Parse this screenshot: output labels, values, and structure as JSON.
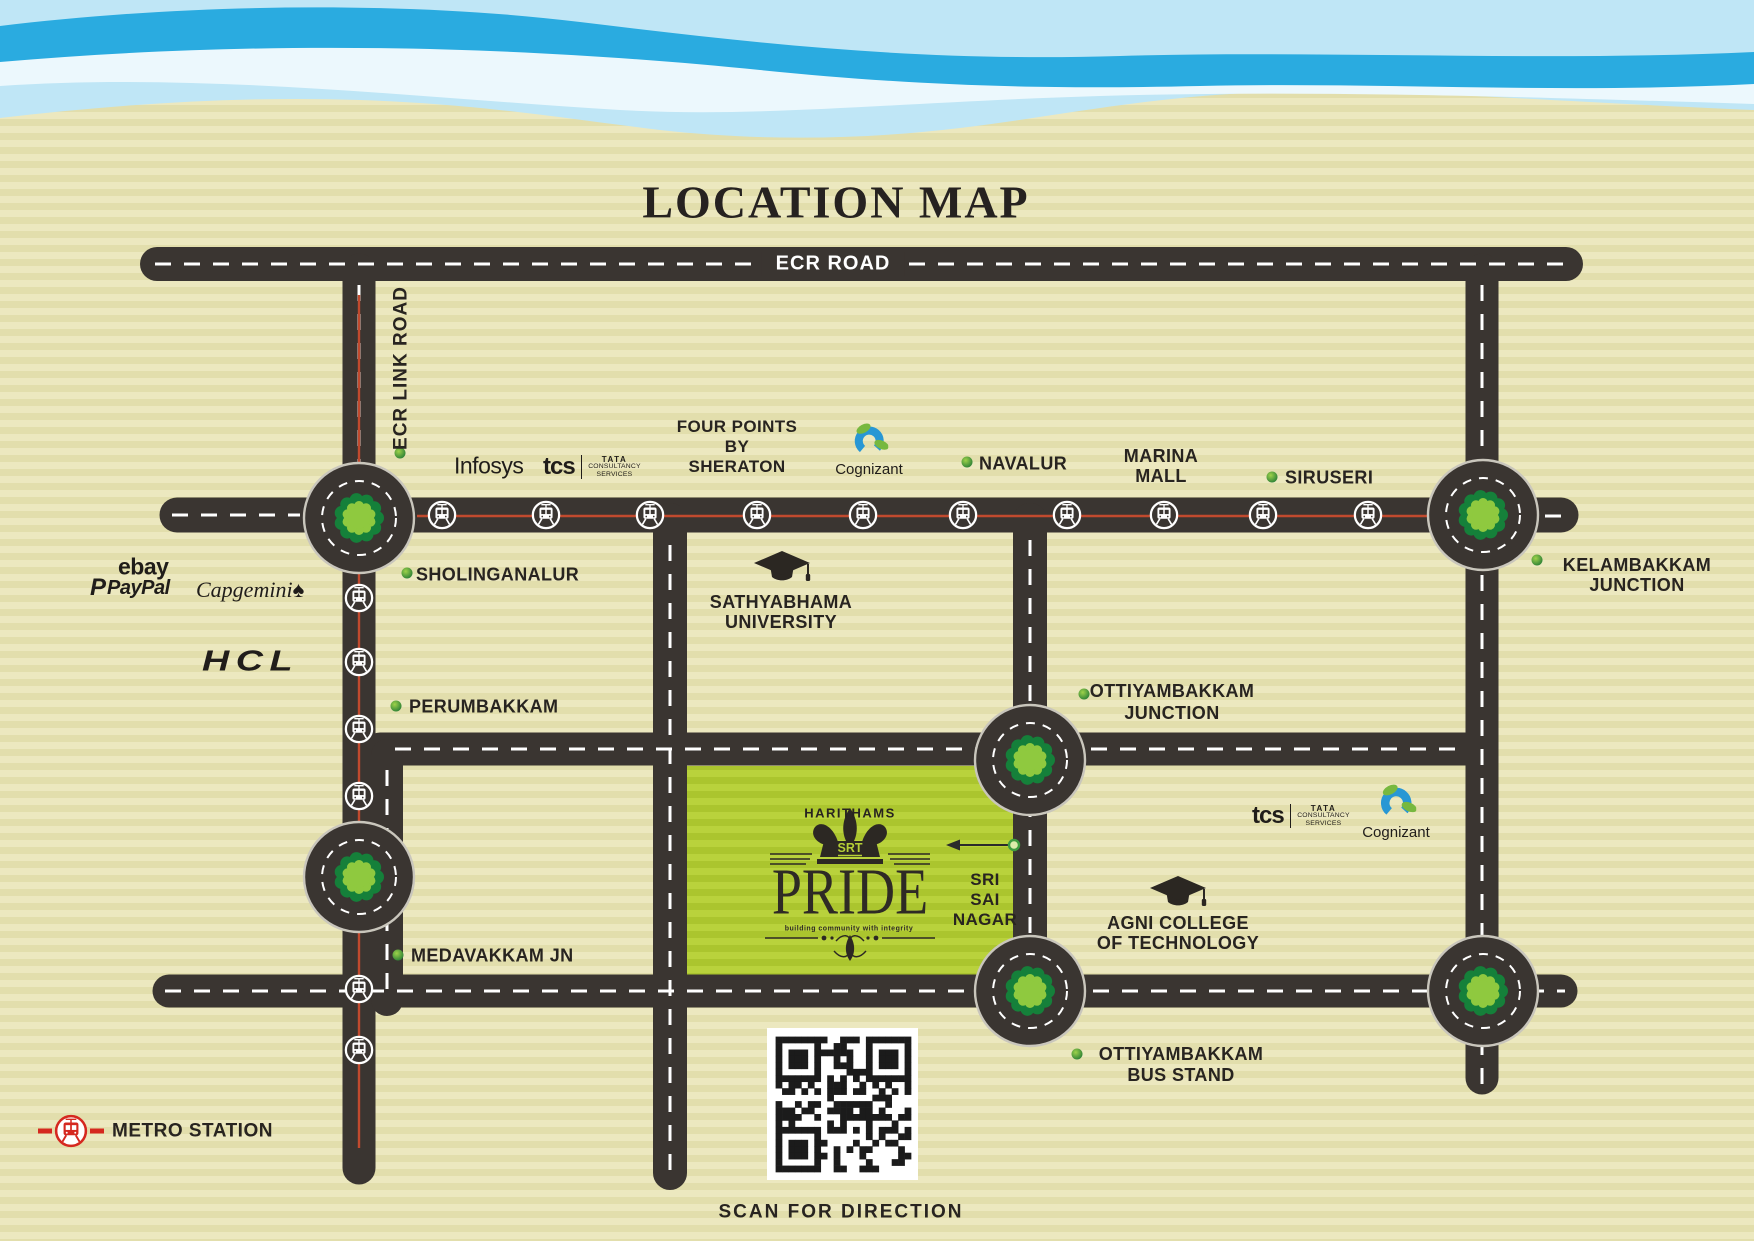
{
  "title": "LOCATION MAP",
  "roads": {
    "ecr": "ECR ROAD",
    "ecr_link": "ECR LINK ROAD"
  },
  "places": {
    "sholinganalur": {
      "label": "SHOLINGANALUR"
    },
    "four_points": {
      "label": "FOUR POINTS\nBY\nSHERATON"
    },
    "navalur": {
      "label": "NAVALUR"
    },
    "marina_mall": {
      "label": "MARINA\nMALL"
    },
    "siruseri": {
      "label": "SIRUSERI"
    },
    "kelambakkam_junction": {
      "label": "KELAMBAKKAM\nJUNCTION"
    },
    "sathyabhama": {
      "label": "SATHYABHAMA\nUNIVERSITY"
    },
    "perumbakkam": {
      "label": "PERUMBAKKAM"
    },
    "ottiyambakkam_junction": {
      "label": "OTTIYAMBAKKAM\nJUNCTION"
    },
    "medavakkam": {
      "label": "MEDAVAKKAM JN"
    },
    "agni_college": {
      "label": "AGNI COLLEGE\nOF TECHNOLOGY"
    },
    "ottiyambakkam_bus_stand": {
      "label": "OTTIYAMBAKKAM\nBUS STAND"
    },
    "sri_sai_nagar": {
      "label": "SRI\nSAI\nNAGAR"
    }
  },
  "companies": {
    "infosys": "Infosys",
    "tcs": "tcs",
    "tata": "TATA",
    "consultancy": "CONSULTANCY",
    "services": "SERVICES",
    "cognizant": "Cognizant",
    "ebay": "ebay",
    "paypal": "PayPal",
    "paypal_mark": "P",
    "capgemini": "Capgemini",
    "capgemini_mark": "♠",
    "hcl": "HCL"
  },
  "project": {
    "brand": "HARITHAMS",
    "monogram": "SRT",
    "name": "PRIDE",
    "tagline": "building community with integrity"
  },
  "legend": {
    "metro_station": "METRO STATION"
  },
  "qr": {
    "caption": "SCAN FOR DIRECTION"
  },
  "colors": {
    "water_light": "#bfe6f6",
    "water_dark": "#2aabe0",
    "paper": "#ece8bf",
    "road": "#3a3531",
    "metro_line": "#c14a2e",
    "tree_dark": "#15803a",
    "tree_light": "#8fc93f",
    "site_green": "#b4ce35",
    "marker_green": "#3f9c40",
    "ink": "#282420"
  },
  "icons": {
    "metro": "tram-in-circle",
    "legend_metro": "red-tram-in-circle",
    "university": "graduation-cap",
    "roundabout_tree": "tree",
    "place_marker": "green-dot",
    "site_arrow": "left-arrow",
    "crown": "crown",
    "qr": "qr-code"
  }
}
